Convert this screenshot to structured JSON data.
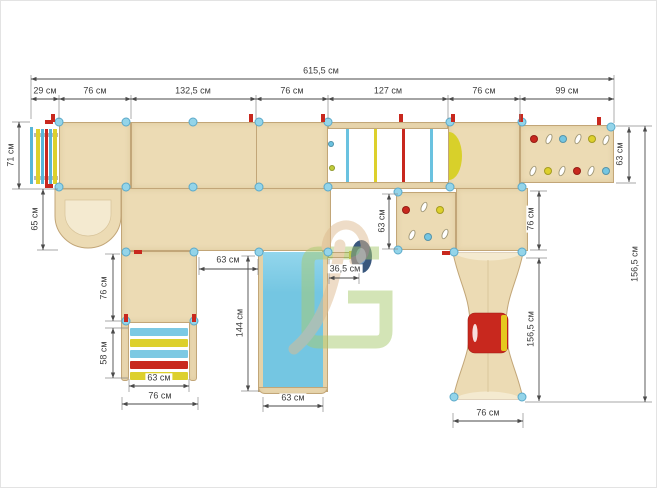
{
  "drawing": {
    "type": "playground-plan-top-view",
    "units": "см"
  },
  "dims": {
    "total": "615,5 см",
    "s29": "29 см",
    "s76a": "76 см",
    "s132": "132,5 см",
    "s76b": "76 см",
    "s127": "127 см",
    "s76c": "76 см",
    "s99": "99 см",
    "l71": "71 см",
    "l65": "65 см",
    "l76": "76 см",
    "l58": "58 см",
    "st63": "63 см",
    "st76": "76 см",
    "gap63": "63 см",
    "slide144": "144 см",
    "slide63": "63 см",
    "scope365": "36,5 см",
    "mid63": "63 см",
    "r63": "63 см",
    "r76": "76 см",
    "tower156": "156,5 см",
    "tower76": "76 см",
    "right_total": "156,5 см"
  },
  "palette": {
    "wood": "#ecdbb4",
    "wood_border": "#c2a678",
    "wood_light": "#f4ead0",
    "blue": "#74c6e2",
    "blue_light": "#93d6ec",
    "red": "#c8281e",
    "yellow": "#ddd02c",
    "connector": "#93d4e9",
    "navy": "#39577d",
    "logo_green": "#a9cb6f",
    "logo_beige": "#debb90",
    "dim_line": "#4a4a4a"
  }
}
